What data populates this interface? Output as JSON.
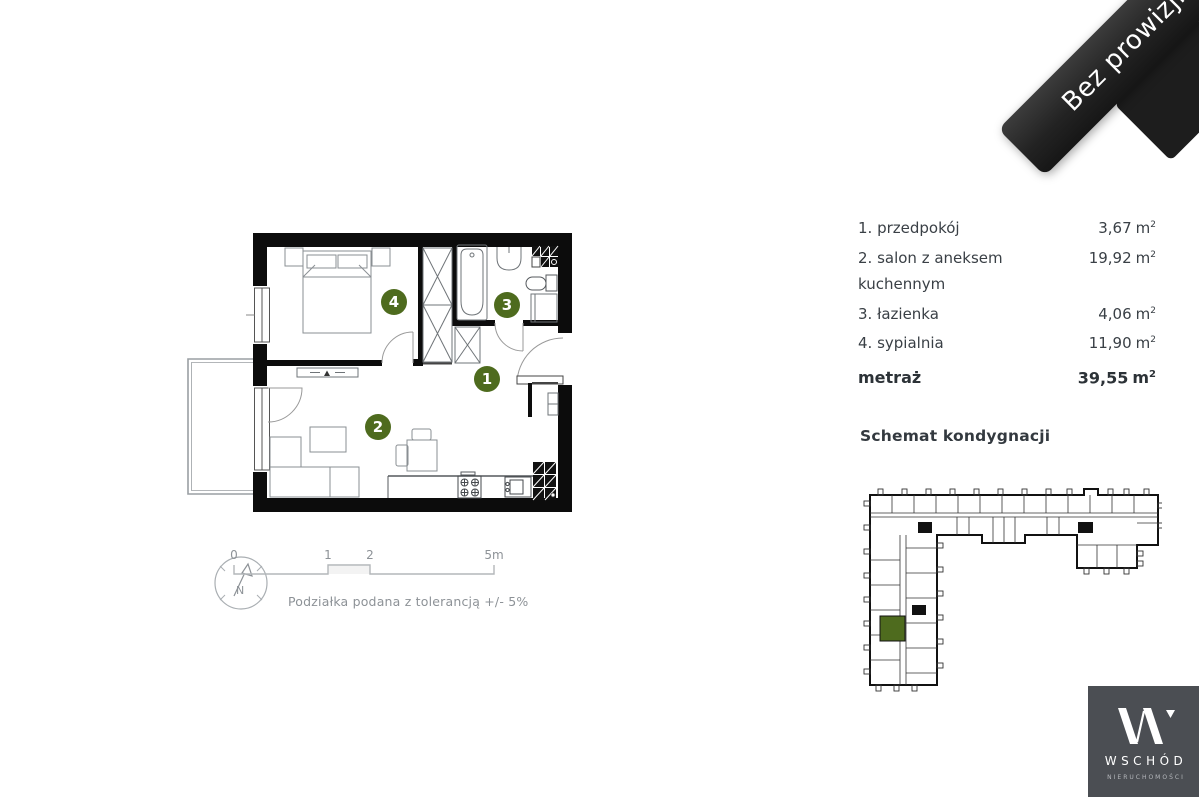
{
  "ribbon": {
    "label": "Bez prowizji"
  },
  "legend": {
    "unit": "m",
    "unit_sup": "2",
    "rooms": [
      {
        "label": "1. przedpokój",
        "area": "3,67"
      },
      {
        "label": "2. salon z aneksem kuchennym",
        "area": "19,92"
      },
      {
        "label": "3. łazienka",
        "area": "4,06"
      },
      {
        "label": "4. sypialnia",
        "area": "11,90"
      }
    ],
    "total": {
      "label": "metraż",
      "area": "39,55"
    }
  },
  "floorplan": {
    "marker_color": "#4e6b1e",
    "markers": [
      {
        "number": "1"
      },
      {
        "number": "2"
      },
      {
        "number": "3"
      },
      {
        "number": "4"
      }
    ]
  },
  "scalebar": {
    "ticks": [
      "0",
      "1",
      "2",
      "5m"
    ],
    "note": "Podziałka podana z tolerancją +/- 5%",
    "compass_label": "N"
  },
  "schematic": {
    "title": "Schemat kondygnacji",
    "highlight_color": "#4e6b1e"
  },
  "logo": {
    "name": "WSCHÓD",
    "subtitle": "NIERUCHOMOŚCI"
  }
}
